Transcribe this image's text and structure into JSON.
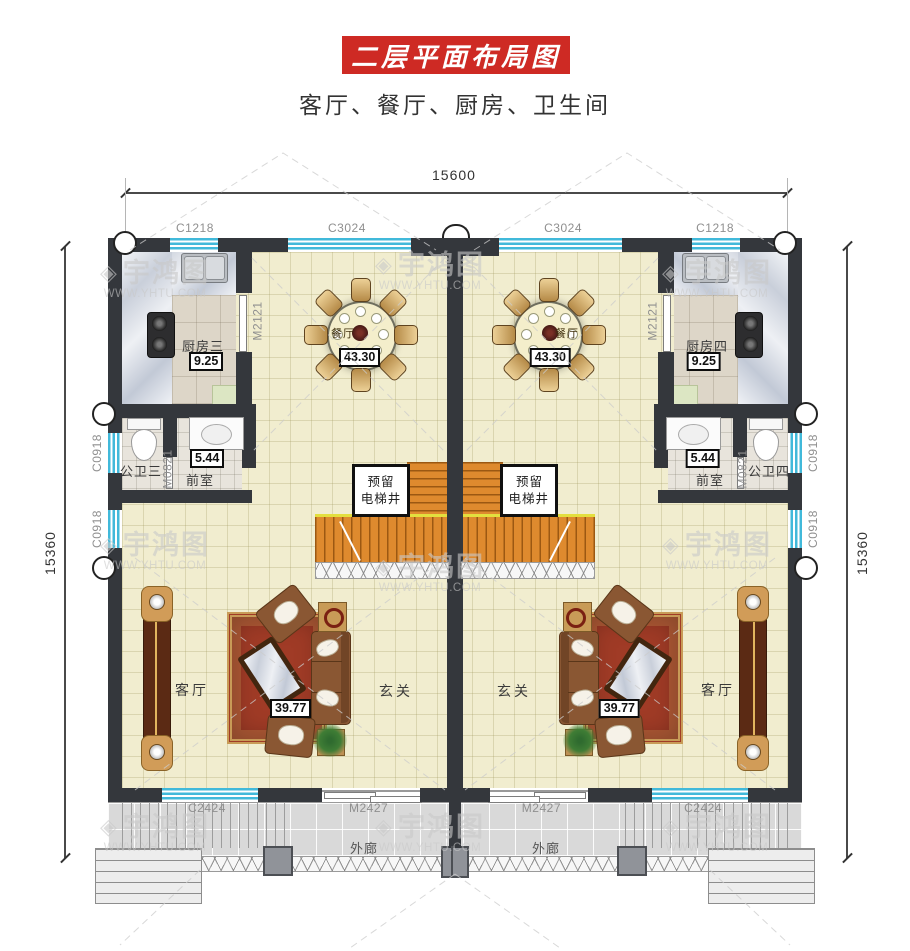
{
  "header": {
    "title": "二层平面布局图",
    "subtitle": "客厅、餐厅、厨房、卫生间"
  },
  "dimensions": {
    "top": "15600",
    "left": "15360",
    "right": "15360"
  },
  "watermark": {
    "brand": "宇鸿图",
    "logo": "watermark-cube-logo",
    "url": "WWW.YHTU.COM"
  },
  "units": {
    "left": {
      "kitchen": {
        "name": "厨房三",
        "area": "9.25"
      },
      "bath": {
        "name": "公卫三"
      },
      "vestibule": {
        "name": "前室",
        "area": "5.44"
      },
      "dining": {
        "name": "餐厅",
        "area": "43.30"
      },
      "living": {
        "name": "客厅",
        "area": "39.77"
      },
      "hall": {
        "name": "玄关"
      },
      "porch": {
        "name": "外廊"
      },
      "elevator": {
        "line1": "预留",
        "line2": "电梯井"
      },
      "openings": {
        "top_corner_window": "C1218",
        "top_wide_window": "C3024",
        "kitchen_door": "M2121",
        "bath_window": "C0918",
        "living_window": "C0918",
        "vestibule_door": "M0821",
        "porch_window": "C2424",
        "porch_door": "M2427"
      }
    },
    "right": {
      "kitchen": {
        "name": "厨房四",
        "area": "9.25"
      },
      "bath": {
        "name": "公卫四"
      },
      "vestibule": {
        "name": "前室",
        "area": "5.44"
      },
      "dining": {
        "name": "餐厅",
        "area": "43.30"
      },
      "living": {
        "name": "客厅",
        "area": "39.77"
      },
      "hall": {
        "name": "玄关"
      },
      "porch": {
        "name": "外廊"
      },
      "elevator": {
        "line1": "预留",
        "line2": "电梯井"
      },
      "openings": {
        "top_corner_window": "C1218",
        "top_wide_window": "C3024",
        "kitchen_door": "M2121",
        "bath_window": "C0918",
        "living_window": "C0918",
        "vestibule_door": "M0821",
        "porch_window": "C2424",
        "porch_door": "M2427"
      }
    }
  },
  "colors": {
    "banner_red": "#ce2a24",
    "wall": "#34373c",
    "window_cyan": "#41b9da",
    "stair_orange": "#de8a2e",
    "carpet_red": "#a03b26",
    "floor_cream": "#f1edcf"
  }
}
